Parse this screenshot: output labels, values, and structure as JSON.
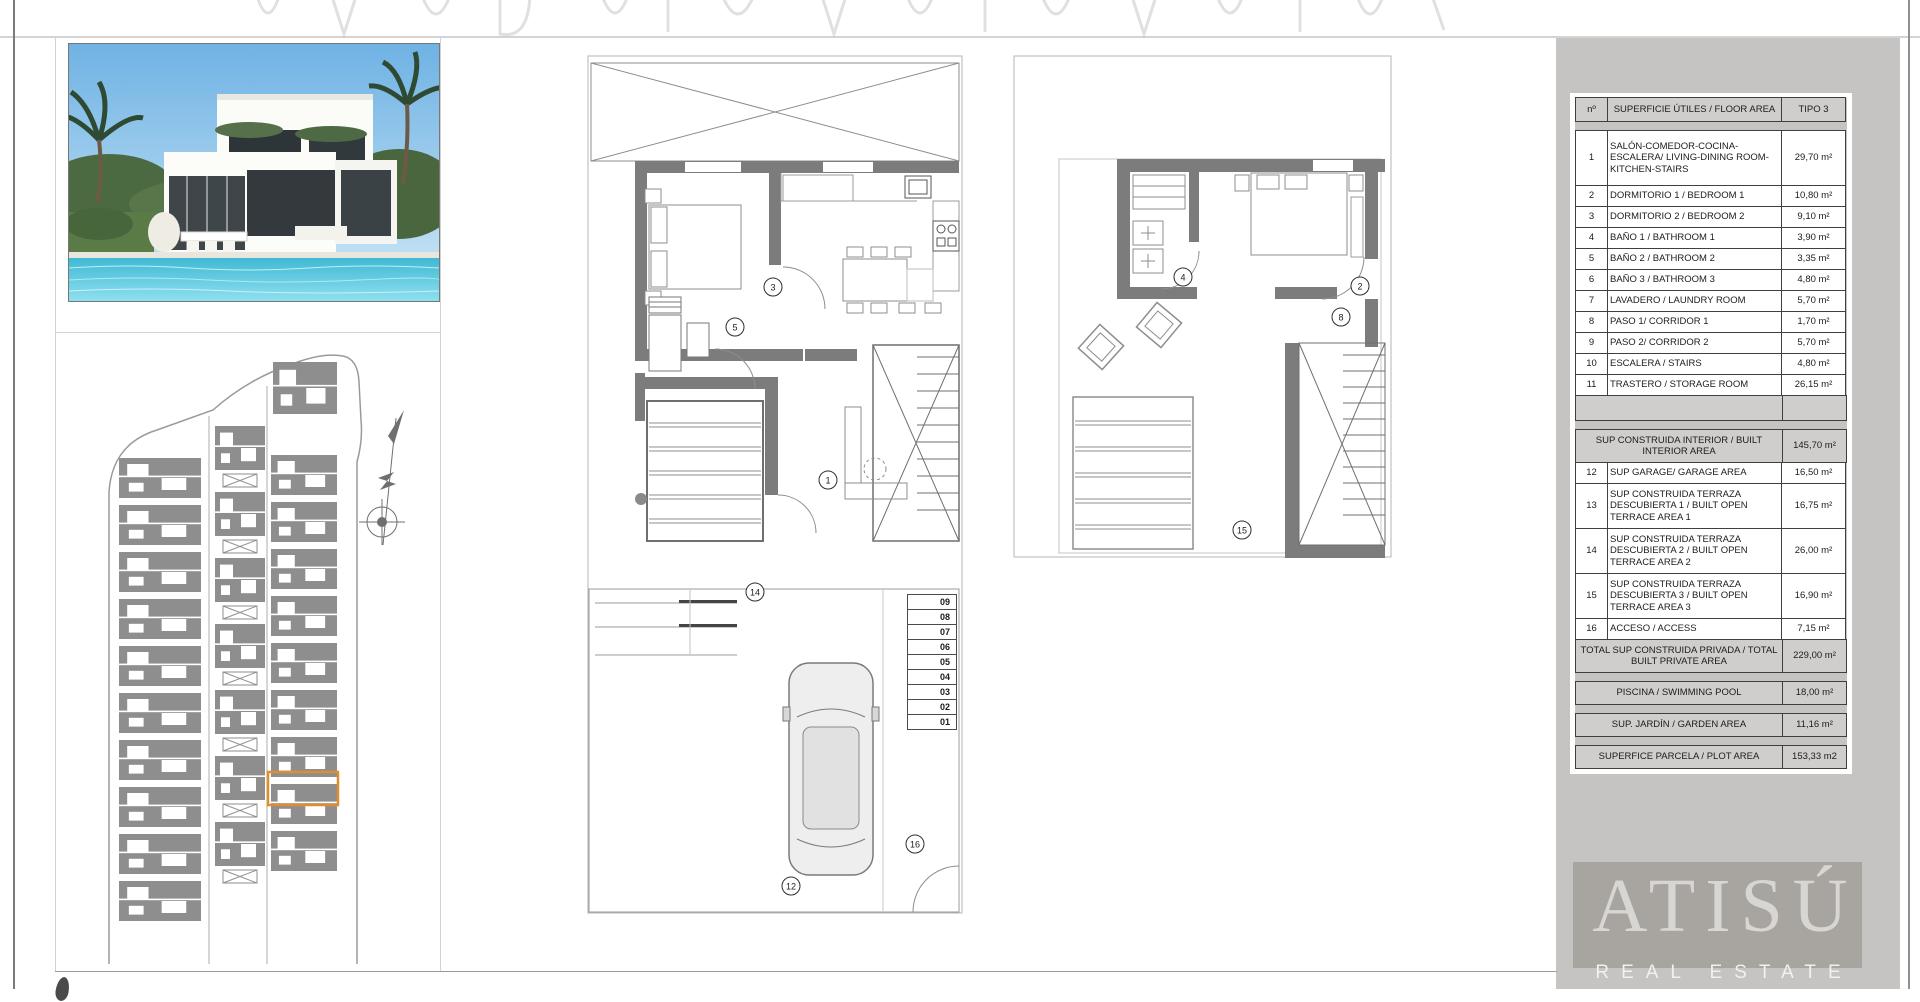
{
  "table": {
    "title_row": {
      "num": "nº",
      "label": "SUPERFICIE ÚTILES / FLOOR AREA",
      "value": "TIPO 3"
    },
    "rows": [
      {
        "kind": "data",
        "lines": 3,
        "first": true,
        "num": "1",
        "label": "SALÓN-COMEDOR-COCINA-ESCALERA/ LIVING-DINING ROOM-KITCHEN-STAIRS",
        "value": "29,70 m²"
      },
      {
        "kind": "data",
        "num": "2",
        "label": "DORMITORIO 1 / BEDROOM 1",
        "value": "10,80 m²"
      },
      {
        "kind": "data",
        "num": "3",
        "label": "DORMITORIO 2 / BEDROOM 2",
        "value": "9,10 m²"
      },
      {
        "kind": "data",
        "num": "4",
        "label": "BAÑO 1 / BATHROOM 1",
        "value": "3,90 m²"
      },
      {
        "kind": "data",
        "num": "5",
        "label": "BAÑO 2 / BATHROOM 2",
        "value": "3,35 m²"
      },
      {
        "kind": "data",
        "num": "6",
        "label": "BAÑO 3 / BATHROOM 3",
        "value": "4,80 m²"
      },
      {
        "kind": "data",
        "num": "7",
        "label": "LAVADERO / LAUNDRY ROOM",
        "value": "5,70 m²"
      },
      {
        "kind": "data",
        "num": "8",
        "label": "PASO 1/ CORRIDOR 1",
        "value": "1,70 m²"
      },
      {
        "kind": "data",
        "num": "9",
        "label": "PASO 2/ CORRIDOR 2",
        "value": "5,70 m²"
      },
      {
        "kind": "data",
        "num": "10",
        "label": "ESCALERA / STAIRS",
        "value": "4,80 m²"
      },
      {
        "kind": "data",
        "num": "11",
        "label": "TRASTERO / STORAGE ROOM",
        "value": "26,15 m²"
      },
      {
        "kind": "blank"
      },
      {
        "kind": "gap"
      },
      {
        "kind": "summary",
        "lines": 2,
        "label": "SUP CONSTRUIDA INTERIOR / BUILT INTERIOR AREA",
        "value": "145,70 m²"
      },
      {
        "kind": "data",
        "num": "12",
        "label": "SUP GARAGE/ GARAGE AREA",
        "value": "16,50 m²"
      },
      {
        "kind": "data",
        "lines": 3,
        "num": "13",
        "label": "SUP CONSTRUIDA TERRAZA DESCUBIERTA 1 / BUILT OPEN TERRACE AREA 1",
        "value": "16,75 m²"
      },
      {
        "kind": "data",
        "lines": 3,
        "num": "14",
        "label": "SUP CONSTRUIDA TERRAZA DESCUBIERTA 2 / BUILT OPEN TERRACE AREA 2",
        "value": "26,00 m²"
      },
      {
        "kind": "data",
        "lines": 3,
        "num": "15",
        "label": "SUP CONSTRUIDA TERRAZA DESCUBIERTA 3 / BUILT OPEN TERRACE AREA 3",
        "value": "16,90 m²"
      },
      {
        "kind": "data",
        "num": "16",
        "label": "ACCESO / ACCESS",
        "value": "7,15 m²"
      },
      {
        "kind": "summary",
        "lines": 2,
        "label": "TOTAL SUP CONSTRUIDA PRIVADA / TOTAL BUILT PRIVATE AREA",
        "value": "229,00 m²"
      },
      {
        "kind": "gap"
      },
      {
        "kind": "summary",
        "label": "PISCINA / SWIMMING POOL",
        "value": "18,00 m²"
      },
      {
        "kind": "gap"
      },
      {
        "kind": "summary",
        "label": "SUP. JARDÍN / GARDEN AREA",
        "value": "11,16 m²"
      },
      {
        "kind": "gap"
      },
      {
        "kind": "summary",
        "label": "SUPERFICE PARCELA / PLOT AREA",
        "value": "153,33 m2"
      }
    ]
  },
  "plans": {
    "ground": {
      "labels": [
        {
          "n": "3",
          "x": 186,
          "y": 232
        },
        {
          "n": "5",
          "x": 148,
          "y": 272
        },
        {
          "n": "1",
          "x": 241,
          "y": 425
        },
        {
          "n": "14",
          "x": 168,
          "y": 537
        },
        {
          "n": "12",
          "x": 204,
          "y": 831
        },
        {
          "n": "16",
          "x": 328,
          "y": 789
        }
      ],
      "stair_numbers": [
        "09",
        "08",
        "07",
        "06",
        "05",
        "04",
        "03",
        "02",
        "01"
      ]
    },
    "upper": {
      "labels": [
        {
          "n": "4",
          "x": 170,
          "y": 222
        },
        {
          "n": "2",
          "x": 347,
          "y": 231
        },
        {
          "n": "8",
          "x": 328,
          "y": 262
        },
        {
          "n": "15",
          "x": 229,
          "y": 475
        }
      ]
    }
  },
  "logo": {
    "brand": "ATISÚ",
    "tagline": "REAL ESTATE"
  },
  "colors": {
    "plot_highlight_orange": "#dd8f2f",
    "sidebar_gray": "#c5c4c2",
    "table_header_gray": "#cfcecc",
    "wall_gray": "#7c7c7c",
    "logo_box_gray": "#a8a5a0"
  }
}
